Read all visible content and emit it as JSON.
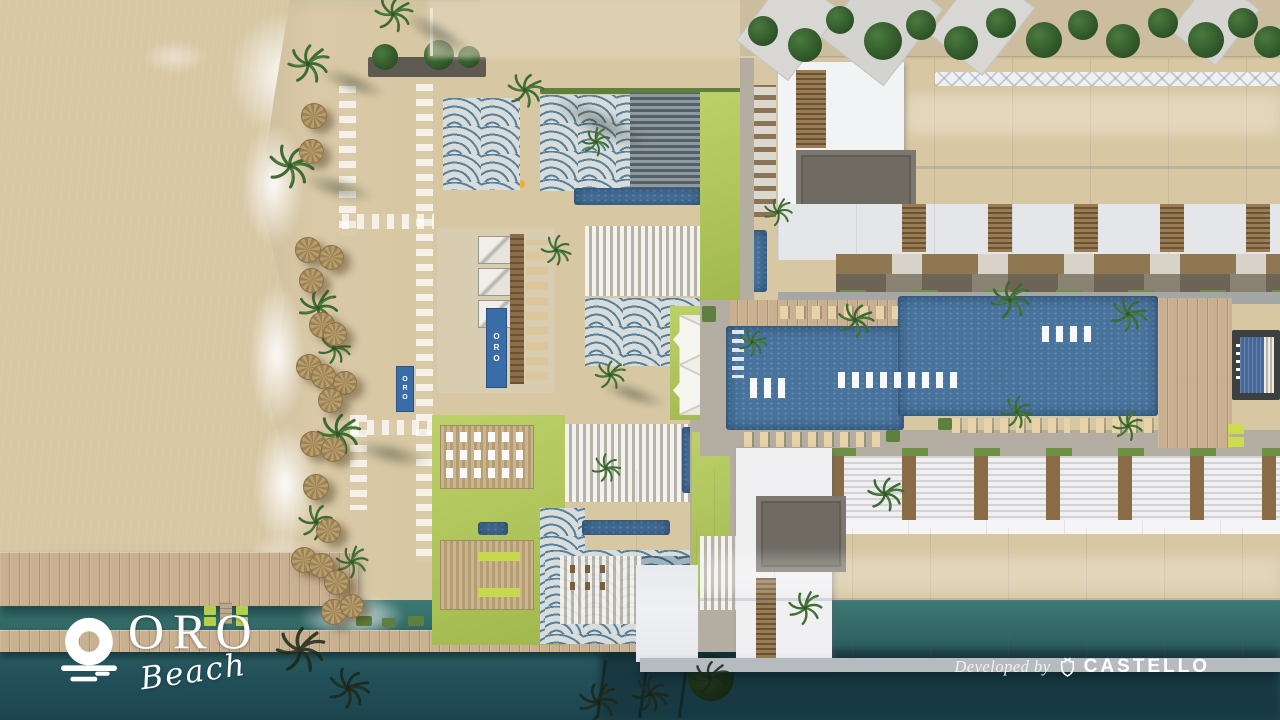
{
  "branding": {
    "logo_text": "ORO",
    "logo_subtext": "Beach",
    "credit_prefix": "Developed by",
    "developer_name": "CASTELLO",
    "beach_flag_text": "ORO"
  },
  "icons": {
    "logo_mark": "sun-over-sea-icon",
    "developer_mark": "shield-crest-icon",
    "vegetation": "palm-tree-icon",
    "beach_item": "straw-umbrella-icon"
  },
  "palette": {
    "sea": "#55a08e",
    "sea-deep": "#3f8580",
    "foam": "#eaf6ee",
    "sand": "#d7c7a3",
    "lawn": "#aec45a",
    "pool": "#48739d",
    "wave-tile": "#56809b",
    "wood": "#c9b091",
    "roof-white": "#eef0f4",
    "roof-dark": "#6f6b63",
    "water-dark": "#1d454e",
    "text": "#ffffff"
  }
}
